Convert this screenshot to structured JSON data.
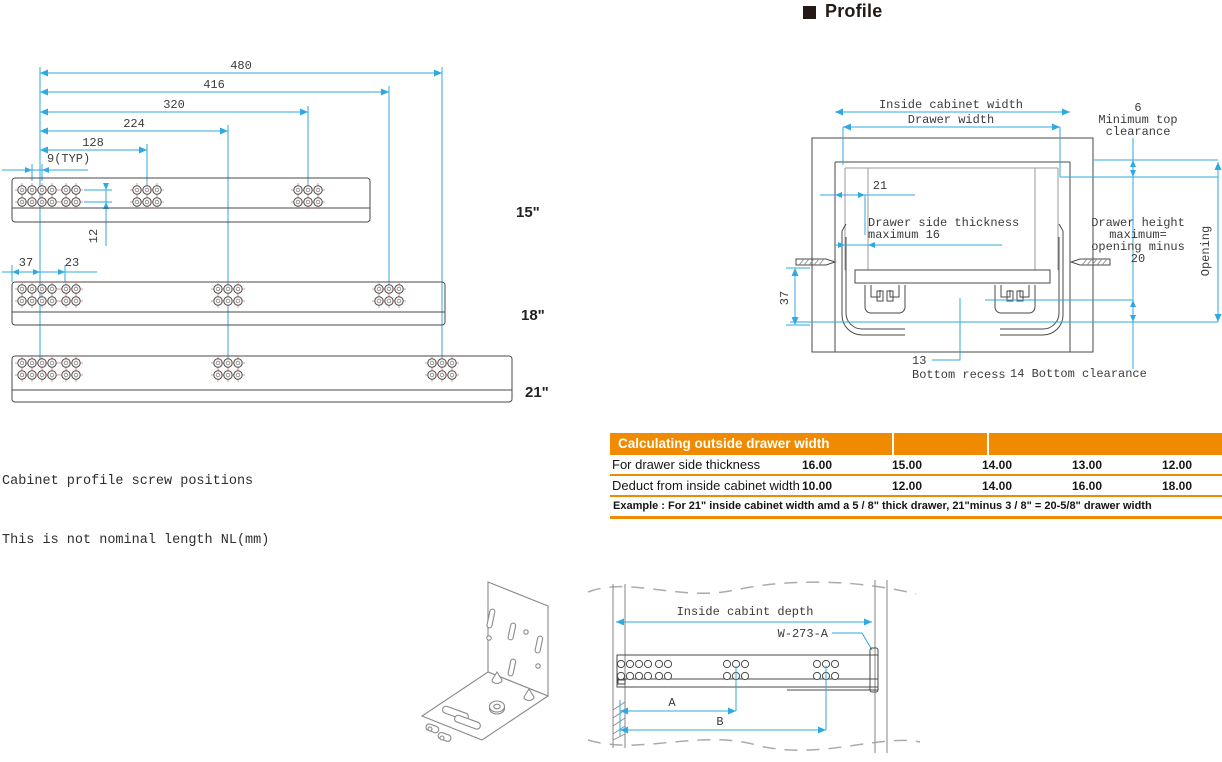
{
  "heading": {
    "title": "Profile"
  },
  "screw_diagram": {
    "caption": [
      "Cabinet profile screw positions",
      "This is not nominal length NL(mm)"
    ],
    "dim_480": "480",
    "dim_416": "416",
    "dim_320": "320",
    "dim_224": "224",
    "dim_128": "128",
    "dim_9typ": "9(TYP)",
    "dim_12": "12",
    "dim_37": "37",
    "dim_23": "23",
    "rail_labels": [
      "15\"",
      "18\"",
      "21\""
    ]
  },
  "profile_diagram": {
    "inside_cabinet_width": "Inside cabinet width",
    "drawer_width": "Drawer width",
    "top_clearance": [
      "6",
      "Minimum top",
      "clearance"
    ],
    "dim_21": "21",
    "side_thickness": [
      "Drawer side thickness",
      "maximum 16"
    ],
    "drawer_height": [
      "Drawer height",
      "maximum=",
      "opening minus",
      "20"
    ],
    "opening": "Opening",
    "dim_37": "37",
    "bottom_recess_value": "13",
    "bottom_recess_label": "Bottom recess",
    "bottom_clearance": "14 Bottom clearance"
  },
  "table": {
    "header": "Calculating outside drawer width",
    "rows": [
      {
        "label": "For drawer side thickness",
        "values": [
          "16.00",
          "15.00",
          "14.00",
          "13.00",
          "12.00"
        ]
      },
      {
        "label": "Deduct from inside cabinet width",
        "values": [
          "10.00",
          "12.00",
          "14.00",
          "16.00",
          "18.00"
        ]
      }
    ],
    "example": "Example : For 21\" inside cabinet width amd a 5 / 8\" thick drawer, 21\"minus 3 / 8\" = 20-5/8\" drawer width"
  },
  "depth_diagram": {
    "inside_cabinet_depth": "Inside cabint depth",
    "part_number": "W-273-A",
    "dim_a": "A",
    "dim_b": "B"
  },
  "colors": {
    "dimension_blue": "#2FA9E1",
    "drawing_gray": "#4a4a4a",
    "table_orange": "#F08A00"
  }
}
